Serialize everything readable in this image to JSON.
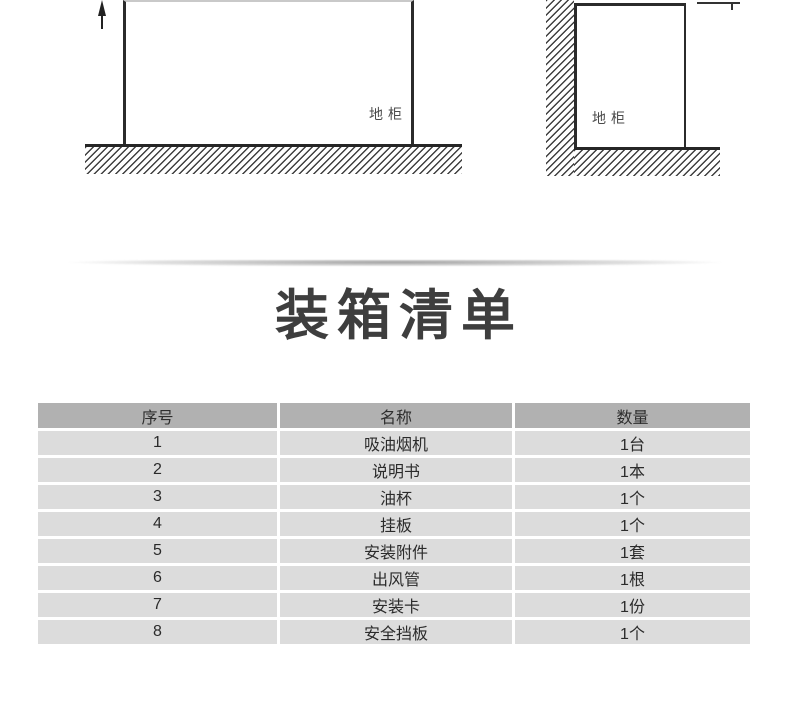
{
  "diagrams": {
    "left_cabinet_label": "地柜",
    "right_cabinet_label": "地柜"
  },
  "title": "装箱清单",
  "packing_table": {
    "headers": [
      "序号",
      "名称",
      "数量"
    ],
    "rows": [
      [
        "1",
        "吸油烟机",
        "1台"
      ],
      [
        "2",
        "说明书",
        "1本"
      ],
      [
        "3",
        "油杯",
        "1个"
      ],
      [
        "4",
        "挂板",
        "1个"
      ],
      [
        "5",
        "安装附件",
        "1套"
      ],
      [
        "6",
        "出风管",
        "1根"
      ],
      [
        "7",
        "安装卡",
        "1份"
      ],
      [
        "8",
        "安全挡板",
        "1个"
      ]
    ]
  },
  "colors": {
    "table_header_bg": "#b1b1b1",
    "table_row_bg": "#dcdcdc",
    "diagram_line": "#2b2b2b",
    "text": "#2e2e2e",
    "title_text": "#3e3e3e"
  }
}
